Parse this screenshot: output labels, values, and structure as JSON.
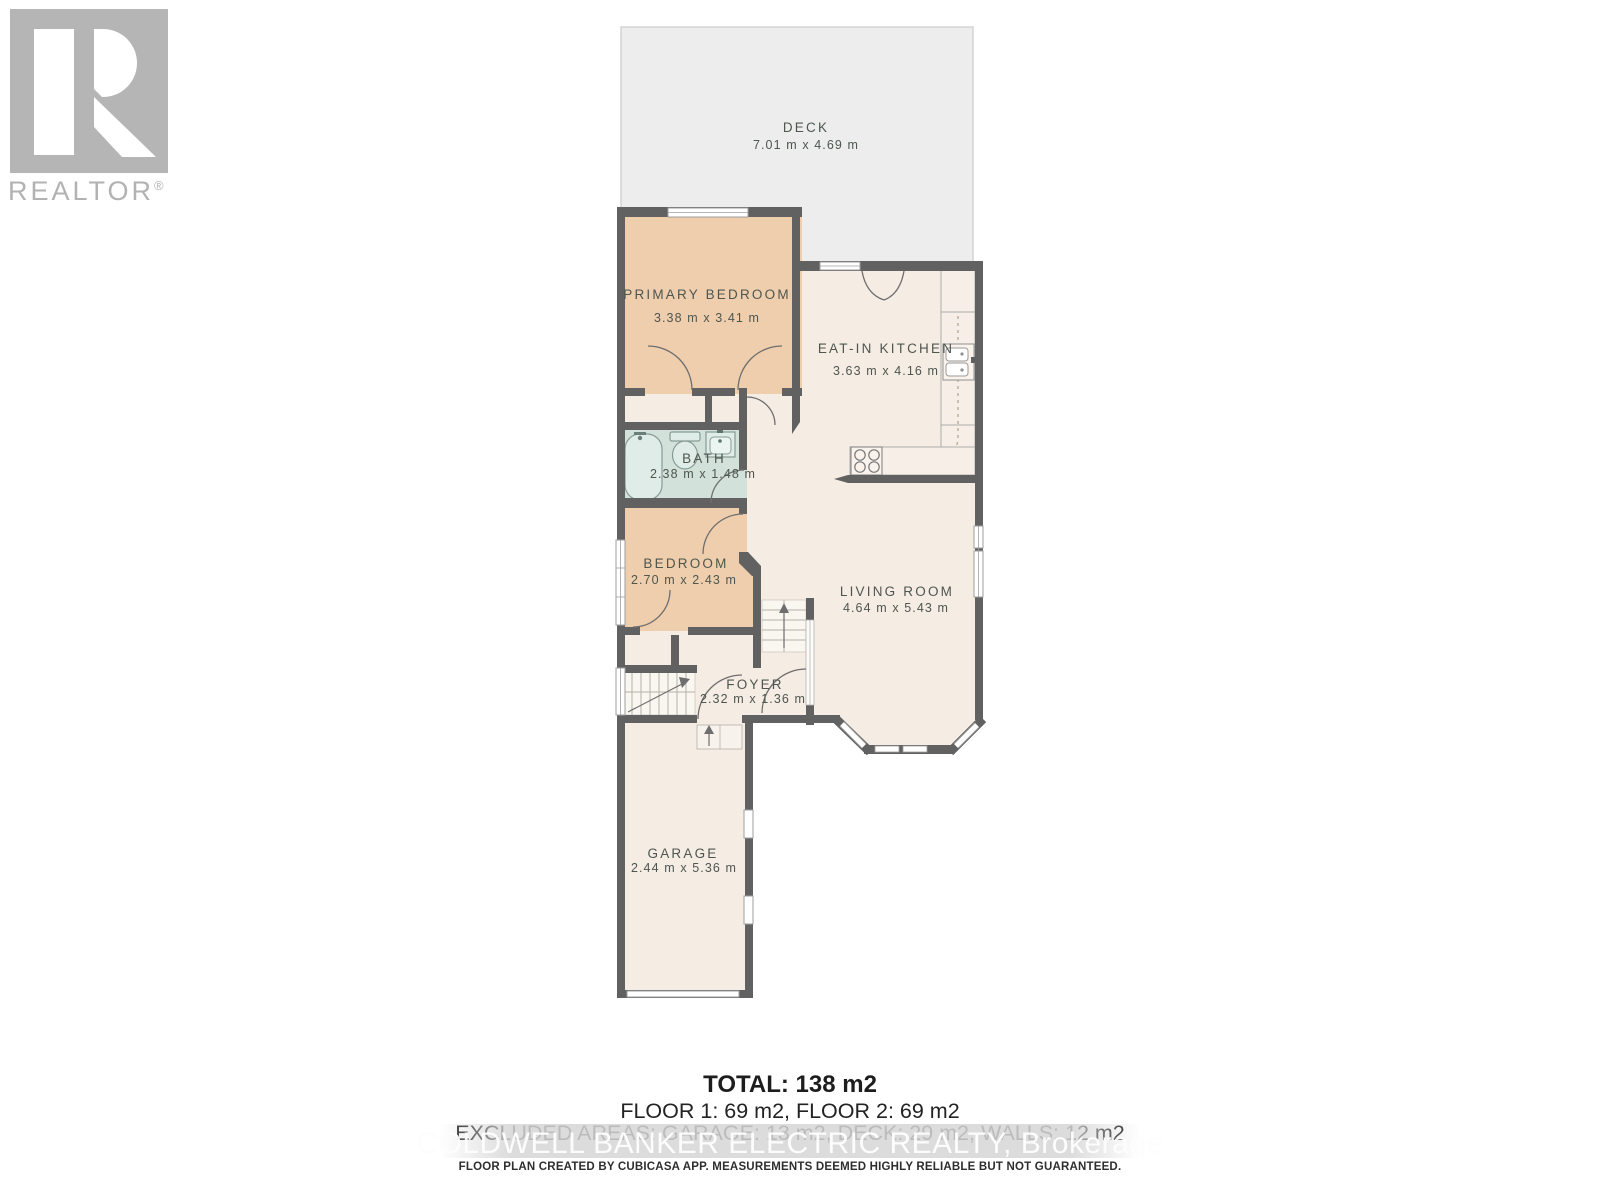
{
  "branding": {
    "logo_name": "REALTOR",
    "logo_mark": "®"
  },
  "rooms": [
    {
      "id": "deck",
      "name": "DECK",
      "dims": "7.01 m x 4.69 m"
    },
    {
      "id": "primary-bedroom",
      "name": "PRIMARY BEDROOM",
      "dims": "3.38 m x 3.41 m"
    },
    {
      "id": "eat-in-kitchen",
      "name": "EAT-IN KITCHEN",
      "dims": "3.63 m x 4.16 m"
    },
    {
      "id": "bath",
      "name": "BATH",
      "dims": "2.38 m x 1.48 m"
    },
    {
      "id": "bedroom",
      "name": "BEDROOM",
      "dims": "2.70 m x 2.43 m"
    },
    {
      "id": "living-room",
      "name": "LIVING ROOM",
      "dims": "4.64 m x 5.43 m"
    },
    {
      "id": "foyer",
      "name": "FOYER",
      "dims": "2.32 m x 1.36 m"
    },
    {
      "id": "garage",
      "name": "GARAGE",
      "dims": "2.44 m x 5.36 m"
    }
  ],
  "summary": {
    "total": "TOTAL: 138 m2",
    "floors": "FLOOR 1: 69 m2, FLOOR 2: 69 m2",
    "excluded": "EXCLUDED AREAS: GARAGE: 13 m2, DECK: 29 m2, WALLS: 12 m2"
  },
  "watermark": "COLDWELL BANKER ELECTRIC REALTY, Brokerage",
  "disclaimer": "FLOOR PLAN CREATED BY CUBICASA APP. MEASUREMENTS DEEMED HIGHLY RELIABLE BUT NOT GUARANTEED.",
  "colors": {
    "wall": "#616161",
    "bedroom_fill": "#efceae",
    "bath_fill": "#d2e1da",
    "room_fill": "#f5ece4",
    "deck_fill": "#ededed",
    "label_text": "#4e564f",
    "logo_gray": "#b2b2b2"
  }
}
